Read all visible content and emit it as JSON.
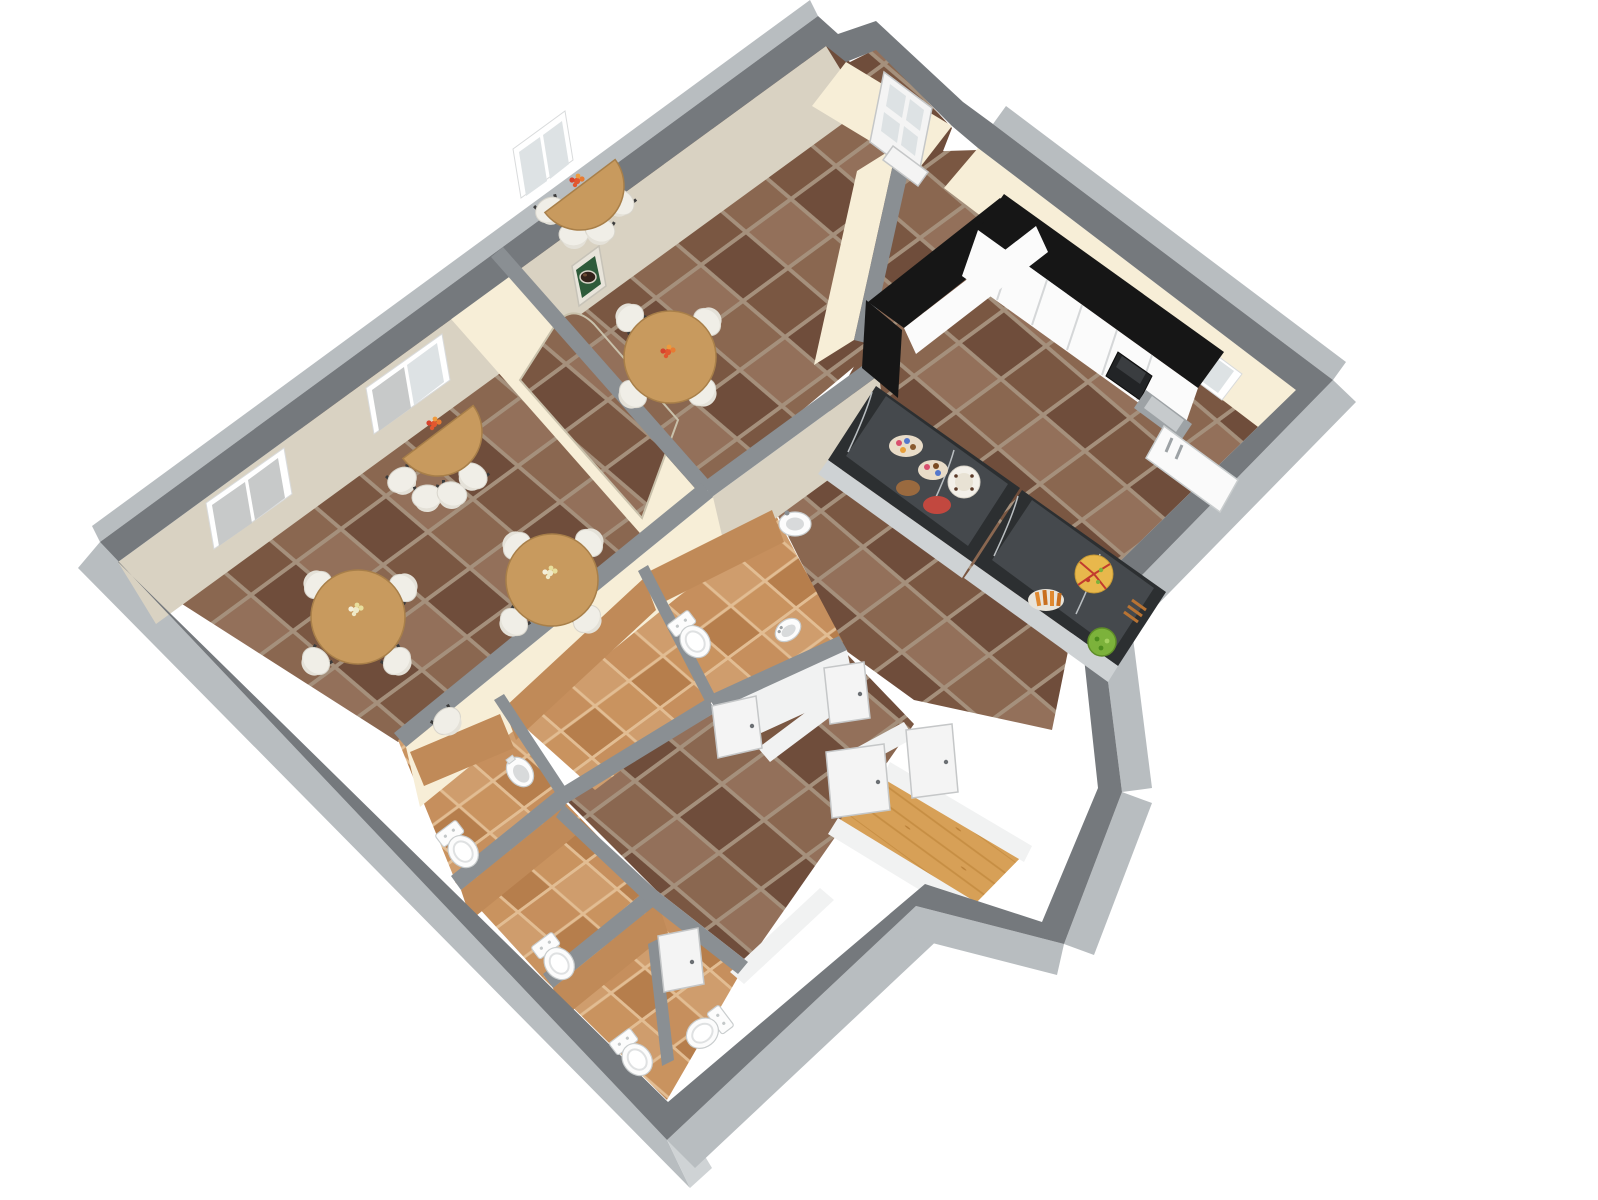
{
  "scene": {
    "title": "3D axonometric floor plan of a small café: two tiled dining rooms with round tables, a serving kitchen with pastry display cases, a WC block with five toilet stalls, and a wooden-floored entry vestibule",
    "view_rotation_deg": -36,
    "background": "#ffffff"
  },
  "colors": {
    "wall_top": "#75797d",
    "wall_top2": "#8a8f93",
    "wall_outer": "#b8bdc0",
    "wall_outer2": "#cfd3d5",
    "wall_inner_cream": "#f7eed7",
    "wall_inner_tan": "#d9d2c2",
    "wall_inner_white": "#f1f2f2",
    "bath_wall": "#c08a58",
    "tile_a": "#8a6750",
    "tile_b": "#7a5742",
    "tile_c": "#93705a",
    "tile_d": "#6f4d3b",
    "tile_grout": "#a5907c",
    "bath_tile_a": "#c68f5d",
    "bath_tile_b": "#cf9d6d",
    "bath_tile_c": "#b67e4c",
    "bath_grout": "#e2bd93",
    "wood_a": "#d7a057",
    "wood_b": "#c68e43",
    "counter_black": "#161616",
    "cabinet_white": "#fbfbfb",
    "case_frame": "#2c2f31",
    "case_glass": "#45494d",
    "case_base": "#ced2d4",
    "table_wood": "#c89a5e",
    "chair_seat": "#f0eee7",
    "chair_leg": "#3c3c3c",
    "fixture_white": "#fcfcfc",
    "fixture_shadow": "#d8dadb",
    "door_white": "#f4f4f4",
    "window_glass": "#dde2e4",
    "blind_gray": "#c7c9c9",
    "clock_green": "#2e5b3a",
    "flower_red": "#e2572f",
    "flower_white": "#efe9c8",
    "food_orange": "#e0892f",
    "food_green": "#7cb23b",
    "food_pink": "#d94f6e",
    "food_blue": "#5577cc",
    "cake_white": "#f3f0e9"
  },
  "inventory": {
    "round_tables": 3,
    "half_round_tables": 2,
    "chairs": 17,
    "toilets": 5,
    "bidets": 1,
    "urinals": 1,
    "wash_basins": 2,
    "display_cases": 2,
    "kitchen_counters": 2,
    "fridges": 1,
    "coffee_machines": 1,
    "windows": 5,
    "interior_doors": 5,
    "entry_doors": 1,
    "wall_pictures": 1
  }
}
